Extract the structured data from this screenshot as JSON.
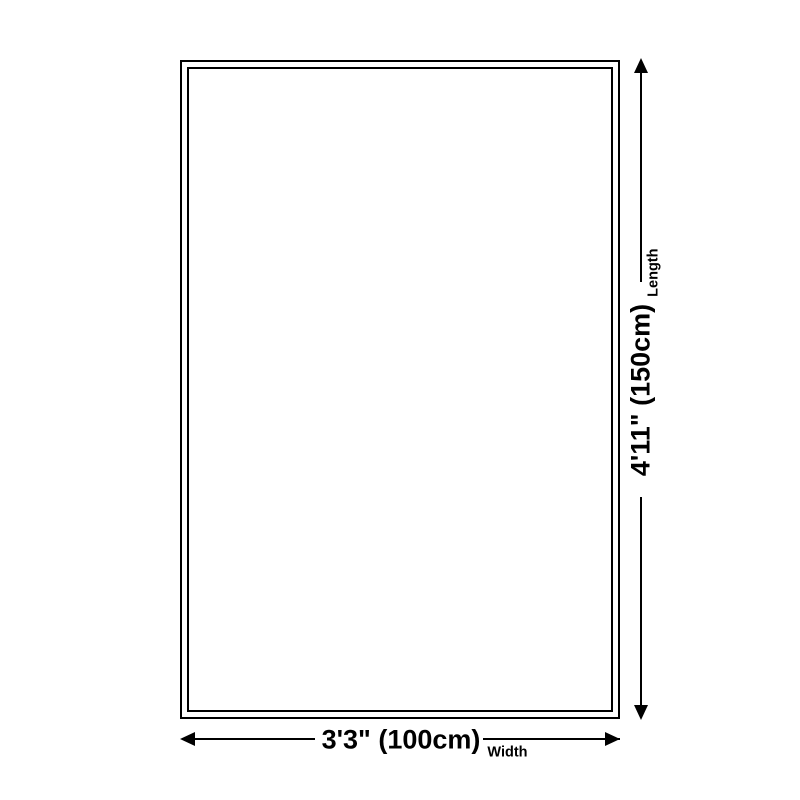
{
  "page": {
    "background_color": "#ffffff",
    "line_color": "#000000"
  },
  "diagram": {
    "kind": "product-size-diagram",
    "shape": "rectangle",
    "length": {
      "value": "4'11\" (150cm)",
      "label": "Length"
    },
    "width": {
      "value": "3'3\" (100cm)",
      "label": "Width"
    }
  }
}
